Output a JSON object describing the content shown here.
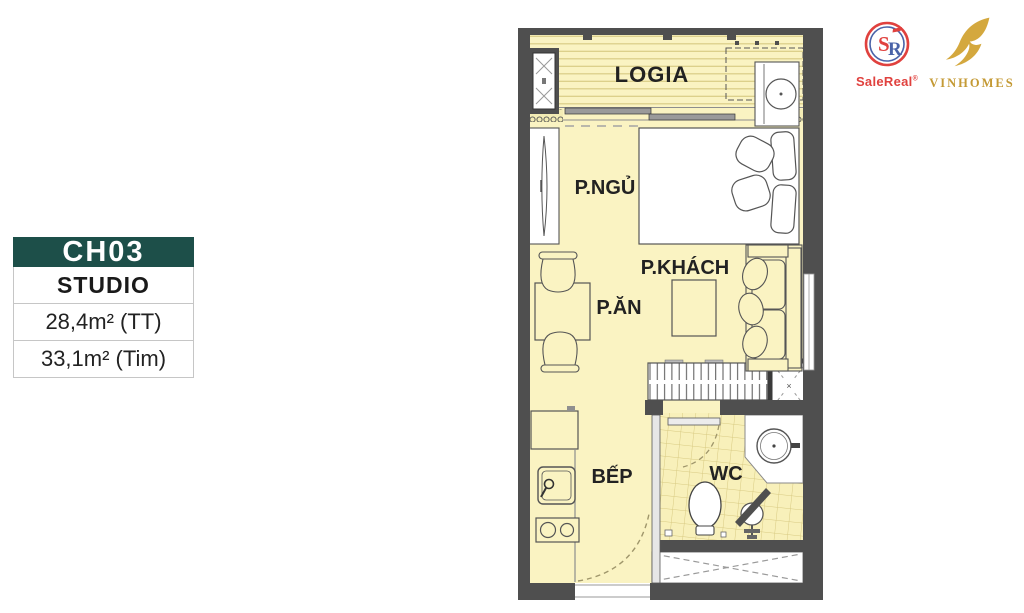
{
  "info_card": {
    "unit_code": "CH03",
    "unit_type": "STUDIO",
    "area_net": "28,4m² (TT)",
    "area_gross": "33,1m² (Tim)",
    "accent_color": "#1d4f49"
  },
  "logos": {
    "salereal": {
      "text": "SaleReal",
      "reg_mark": "®",
      "monogram_s": "S",
      "monogram_r": "R",
      "color_red": "#e0413e",
      "color_blue": "#4a63a8"
    },
    "vinhomes": {
      "text": "VINHOMES",
      "color_gold": "#c49a35"
    }
  },
  "floorplan": {
    "labels": {
      "logia": "LOGIA",
      "bedroom": "P.NGỦ",
      "living": "P.KHÁCH",
      "dining": "P.ĂN",
      "kitchen": "BẾP",
      "wc": "WC"
    },
    "shaft_mark": "×",
    "colors": {
      "floor": "#faf3c2",
      "wall": "#4f4f4f",
      "deck_stripe": "#d9cc85",
      "tile_line": "#d8ca82"
    }
  }
}
